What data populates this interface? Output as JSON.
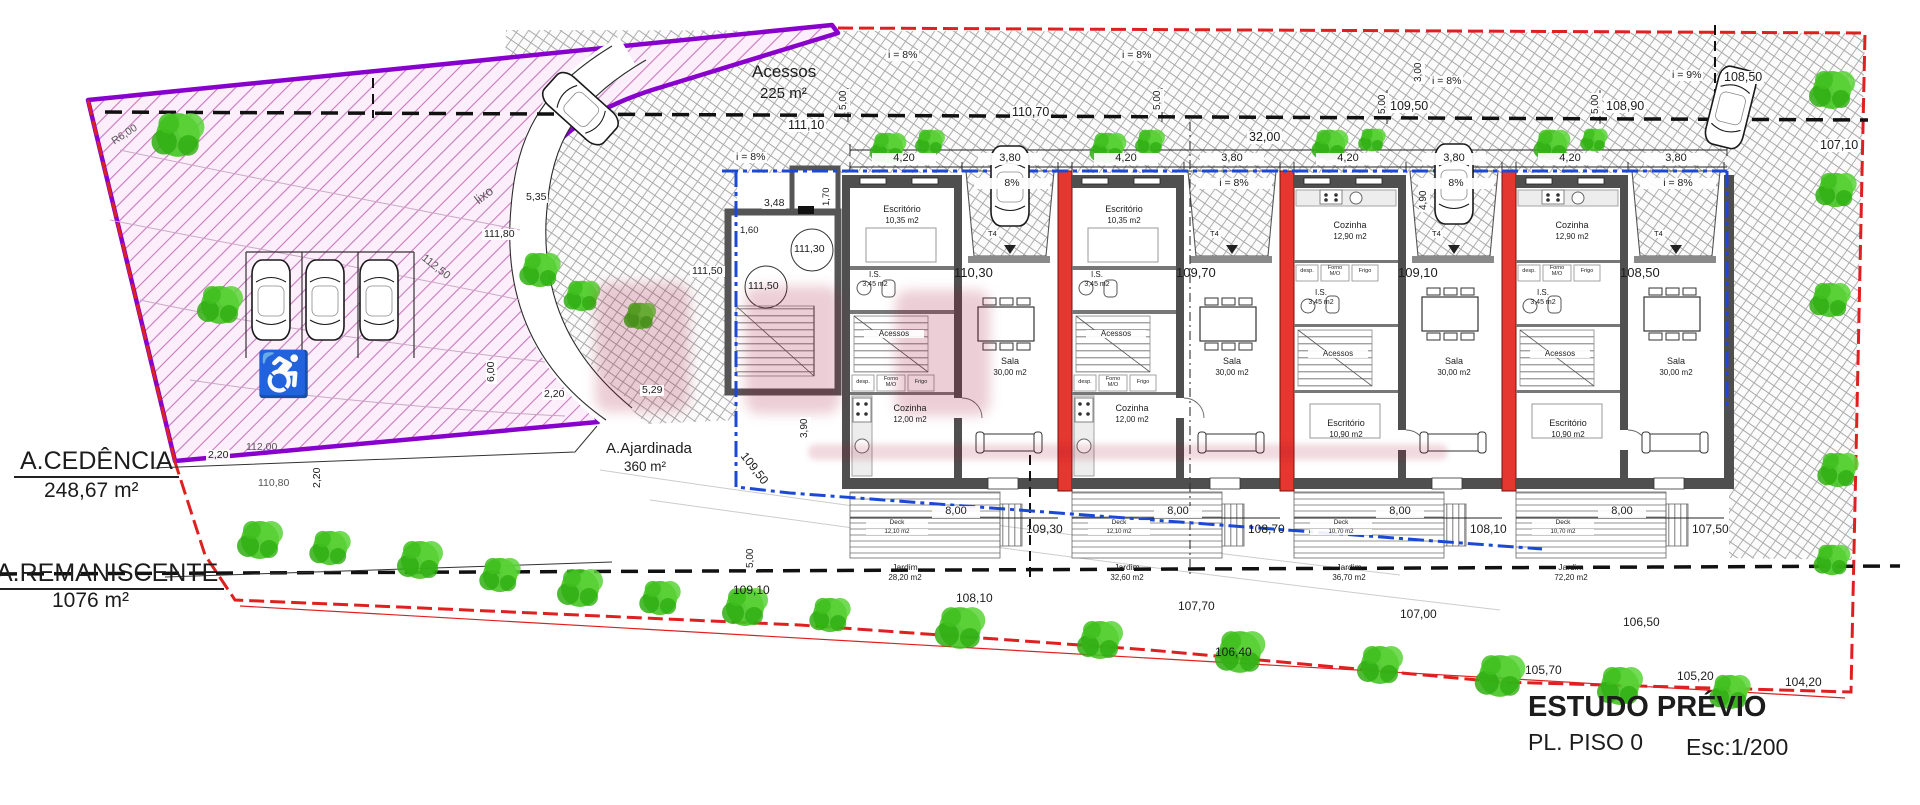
{
  "colors": {
    "boundary_red": "#e02020",
    "boundary_blue": "#1b49d6",
    "cedencia_purple": "#8800cc",
    "party_wall_red": "#e5372f",
    "wall_gray": "#4f4f4f",
    "tree_green": "#3bc11c",
    "pink_hatch_bg": "#fdeefb"
  },
  "title_block": {
    "title": "ESTUDO PRÉVIO",
    "subtitle": "PL. PISO 0",
    "scale": "Esc:1/200"
  },
  "areas": {
    "acessos": {
      "name": "Acessos",
      "area": "225 m²"
    },
    "cedencia": {
      "name": "A.CEDÊNCIA",
      "area": "248,67 m²"
    },
    "remaniscente": {
      "name": "A.REMANISCENTE",
      "area": "1076 m²"
    },
    "ajardinada": {
      "name": "A.Ajardinada",
      "area": "360 m²"
    }
  },
  "misc": {
    "lixo": "lixo"
  },
  "stairwell": {
    "level_top": "111,30",
    "level_mid": "111,50",
    "side_level": "111,50",
    "dims": {
      "w": "3,48",
      "inner": "1,60",
      "d": "1,70"
    },
    "left_dims": {
      "a": "5,35",
      "b": "111,80"
    }
  },
  "dimensions": {
    "overall": "32,00",
    "setbacks": [
      "5,00",
      "5,00",
      "5,00",
      "5,00"
    ],
    "right": {
      "a": "3,00",
      "b": "4,90"
    },
    "garden": {
      "depth": "3,90",
      "left": "5,00",
      "front": "5,29"
    },
    "cedencia": {
      "a": "2,20",
      "b": "2,20",
      "c": "2,20",
      "d": "6,00"
    },
    "contours": {
      "a": "112,50",
      "b": "112,00",
      "c": "110,80"
    },
    "radius": "R6,00",
    "envelope_level": "109,50"
  },
  "slopes": [
    "i = 8%",
    "i = 8%",
    "i = 8%",
    "i = 8%",
    "i = 9%"
  ],
  "levels": {
    "road": [
      "111,10",
      "110,70",
      "109,50",
      "108,90",
      "108,50",
      "107,10"
    ],
    "garden_upper": [
      "109,10",
      "108,10",
      "107,70",
      "107,00",
      "106,50"
    ],
    "garden_lower": [
      "106,40",
      "105,70",
      "105,20",
      "104,20"
    ]
  },
  "units": [
    {
      "id": "unit-1",
      "type_label": "T4",
      "entry_level": "110,30",
      "width_dim": "4,20",
      "bay_dim": "3,80",
      "ramp": "8%",
      "room_top": {
        "name": "Escritório",
        "area": "10,35 m2"
      },
      "wc": {
        "name": "I.S.",
        "area": "3,45 m2"
      },
      "stairs_label": "Acessos",
      "pantry": "desp.",
      "oven": "Forno M/O",
      "fridge": "Frigo",
      "room_bottom": {
        "name": "Cozinha",
        "area": "12,00 m2"
      },
      "living": {
        "name": "Sala",
        "area": "30,00 m2"
      },
      "deck": {
        "name": "Deck",
        "area": "12,10 m2",
        "level": "109,30"
      },
      "garden_dim": "8,00",
      "garden": {
        "name": "Jardim",
        "area": "28,20 m2"
      }
    },
    {
      "id": "unit-2",
      "type_label": "T4",
      "entry_level": "109,70",
      "width_dim": "4,20",
      "bay_dim": "3,80",
      "ramp": "i = 8%",
      "room_top": {
        "name": "Escritório",
        "area": "10,35 m2"
      },
      "wc": {
        "name": "I.S.",
        "area": "3,45 m2"
      },
      "stairs_label": "Acessos",
      "pantry": "desp.",
      "oven": "Forno M/O",
      "fridge": "Frigo",
      "room_bottom": {
        "name": "Cozinha",
        "area": "12,00 m2"
      },
      "living": {
        "name": "Sala",
        "area": "30,00 m2"
      },
      "deck": {
        "name": "Deck",
        "area": "12,10 m2",
        "level": "108,70"
      },
      "garden_dim": "8,00",
      "garden": {
        "name": "Jardim",
        "area": "32,60 m2"
      }
    },
    {
      "id": "unit-3",
      "type_label": "T4",
      "entry_level": "109,10",
      "width_dim": "4,20",
      "bay_dim": "3,80",
      "ramp": "8%",
      "room_top": {
        "name": "Cozinha",
        "area": "12,90 m2"
      },
      "wc": {
        "name": "I.S.",
        "area": "3,45 m2"
      },
      "stairs_label": "Acessos",
      "pantry": "desp.",
      "oven": "Forno M/O",
      "fridge": "Frigo",
      "room_bottom": {
        "name": "Escritório",
        "area": "10,90 m2"
      },
      "living": {
        "name": "Sala",
        "area": "30,00 m2"
      },
      "deck": {
        "name": "Deck",
        "area": "10,70 m2",
        "level": "108,10"
      },
      "garden_dim": "8,00",
      "garden": {
        "name": "Jardim",
        "area": "36,70 m2"
      }
    },
    {
      "id": "unit-4",
      "type_label": "T4",
      "entry_level": "108,50",
      "width_dim": "4,20",
      "bay_dim": "3,80",
      "ramp": "i = 8%",
      "room_top": {
        "name": "Cozinha",
        "area": "12,90 m2"
      },
      "wc": {
        "name": "I.S.",
        "area": "3,45 m2"
      },
      "stairs_label": "Acessos",
      "pantry": "desp.",
      "oven": "Forno M/O",
      "fridge": "Frigo",
      "room_bottom": {
        "name": "Escritório",
        "area": "10,90 m2"
      },
      "living": {
        "name": "Sala",
        "area": "30,00 m2"
      },
      "deck": {
        "name": "Deck",
        "area": "10,70 m2",
        "level": "107,50"
      },
      "garden_dim": "8,00",
      "garden": {
        "name": "Jardim",
        "area": "72,20 m2"
      }
    }
  ]
}
